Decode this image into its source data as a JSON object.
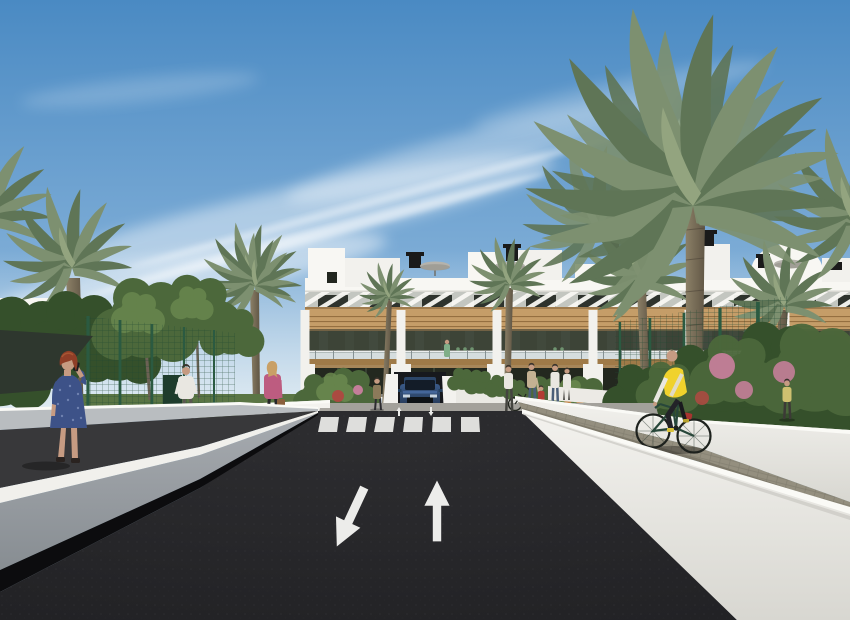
{
  "meta": {
    "title": "Architectural rendering of a modern white apartment complex street view",
    "type": "3d-exterior-render",
    "width": 850,
    "height": 620
  },
  "colors": {
    "sky_top": "#4a8ac3",
    "sky_mid": "#8db7dc",
    "sky_low": "#cadeeb",
    "cloud": "#ffffff",
    "haze": "#e3edf3",
    "facade": "#f2f1ed",
    "facade_bright": "#f8f7f3",
    "facade_shade": "#d9d8d2",
    "slat_bg": "#c3c6c0",
    "window_dark": "#2e332d",
    "window_lite": "#4b5449",
    "wood": "#c59d68",
    "wood_dark": "#9f7a48",
    "wood_slat": "#8a6436",
    "balcony_dark": "#3d4437",
    "rail_glass": "#cdd8da",
    "rail_post": "#7e8a8c",
    "ground_glass": "#23281f",
    "shrub": "#4c683b",
    "shrub_light": "#6b894f",
    "shrub_dark": "#35502b",
    "grass": "#5a7544",
    "palm1": "#7d9070",
    "palm2": "#5f7556",
    "palm3": "#93a47f",
    "trunk_light": "#8d8168",
    "trunk_dark": "#5f5544",
    "flower_pink": "#c47e99",
    "flower_red": "#ab4a41",
    "flower_orange": "#c08347",
    "fence_green": "#2b5a41",
    "fence_mesh": "#1e4631",
    "road": "#212124",
    "road_hi": "#2d2d30",
    "marking": "#ececea",
    "curb": "#f1f0ec",
    "gray_wall": "#a7abb0",
    "gray_wall_dark": "#878d92",
    "dark_path": "#38383a",
    "shadow_band": "#0c0c0e",
    "rwall": "#f3f2ee",
    "rwall_shade": "#d8d7d1",
    "coping": "#fafaf6",
    "cobble": "#948f7f",
    "cobble_dark": "#7d7869",
    "lpath": "#b4b2ac",
    "walk": "#a3a19b",
    "car_body": "#3a5a88",
    "car_body_dark": "#22344f",
    "car_glass": "#131c28",
    "skin": "#c69b82",
    "dress_blue": "#3d5288",
    "dress_dot": "#6f81b0",
    "hair_red": "#8f3e27",
    "hair_blonde": "#c9a066",
    "hair_dark": "#3a332c",
    "jacket_pink": "#bd5c80",
    "jeans": "#4a5e78",
    "white_cloth": "#e9e7e1",
    "khaki": "#8c7a5a",
    "vest_yellow": "#f0d22c",
    "red_cloth": "#b23c33",
    "bag_tan": "#8a5f3c",
    "umbrella": "#b5b3ac",
    "chimney": "#1a1a1a",
    "sail": "#2e372e"
  },
  "scene": {
    "sky": {
      "label": "Blue sky with wispy cirrus clouds",
      "cloud_count": 7
    },
    "building": {
      "label": "White modern three-storey apartment block with wood accents, slatted sun screens, glass balustrades and roof terraces",
      "floors": 3,
      "balcony_modules": 6,
      "roof": {
        "chimneys": 6,
        "parasols": 3,
        "penthouse_volumes": 6
      }
    },
    "vegetation": {
      "label": "Palm trees, leafy trees and flowering shrubs",
      "palm_trees": 8,
      "leafy_trees": 5,
      "flower_colors": [
        "pink",
        "red",
        "orange"
      ],
      "court_fences": 2
    },
    "road": {
      "label": "Dark asphalt street with zebra crossing and painted lane arrows",
      "crosswalk_stripes": 6,
      "lane_arrows": [
        {
          "direction": "down-left (toward viewer)"
        },
        {
          "direction": "up (away from viewer)"
        }
      ],
      "ramp_arrows": 2
    },
    "vehicle": {
      "label": "Dark blue SUV exiting the underground garage ramp"
    },
    "figures": [
      {
        "id": "woman-on-phone",
        "label": "Woman with red hair in a blue dress talking on the phone"
      },
      {
        "id": "man-walking",
        "label": "Man in a white t-shirt walking on the upper path"
      },
      {
        "id": "woman-pink-jacket",
        "label": "Blonde woman in a pink jacket carrying a handbag"
      },
      {
        "id": "pedestrian-ramp",
        "label": "Pedestrian standing beside the garage ramp"
      },
      {
        "id": "woman-with-bicycle",
        "label": "Woman standing with a bicycle near the crosswalk"
      },
      {
        "id": "adult-with-child",
        "label": "Adult walking with a child"
      },
      {
        "id": "child-red",
        "label": "Child in a red shirt"
      },
      {
        "id": "pedestrian-jeans",
        "label": "Pedestrian in jeans near the crosswalk"
      },
      {
        "id": "cyclist",
        "label": "Cyclist in a yellow vest riding along the white wall"
      },
      {
        "id": "pedestrian-far-right",
        "label": "Pedestrian on the far right walkway"
      },
      {
        "id": "balcony-residents",
        "label": "Residents standing on the balconies"
      },
      {
        "id": "terrace-figure",
        "label": "Figure on the ground-floor terrace"
      }
    ]
  }
}
